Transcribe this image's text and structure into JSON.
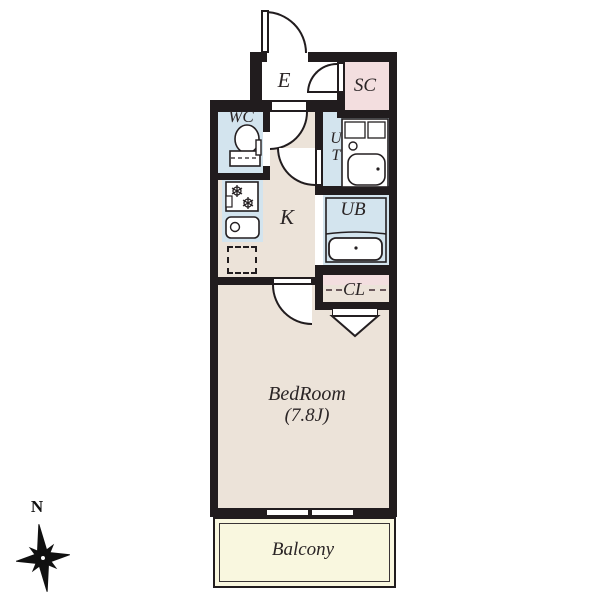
{
  "colors": {
    "wall": "#211c1e",
    "beige": "#ece3d9",
    "blue": "#d3e4ee",
    "pink": "#f3dedf",
    "yellow": "#f9f7df",
    "ink": "#2b2526"
  },
  "labels": {
    "entrance": "E",
    "shoe_closet": "SC",
    "toilet": "WC",
    "utility_u": "U",
    "utility_t": "T",
    "unit_bath": "UB",
    "kitchen": "K",
    "closet": "CL",
    "bedroom": "BedRoom",
    "bedroom_size": "(7.8J)",
    "balcony": "Balcony",
    "compass_north": "N"
  }
}
